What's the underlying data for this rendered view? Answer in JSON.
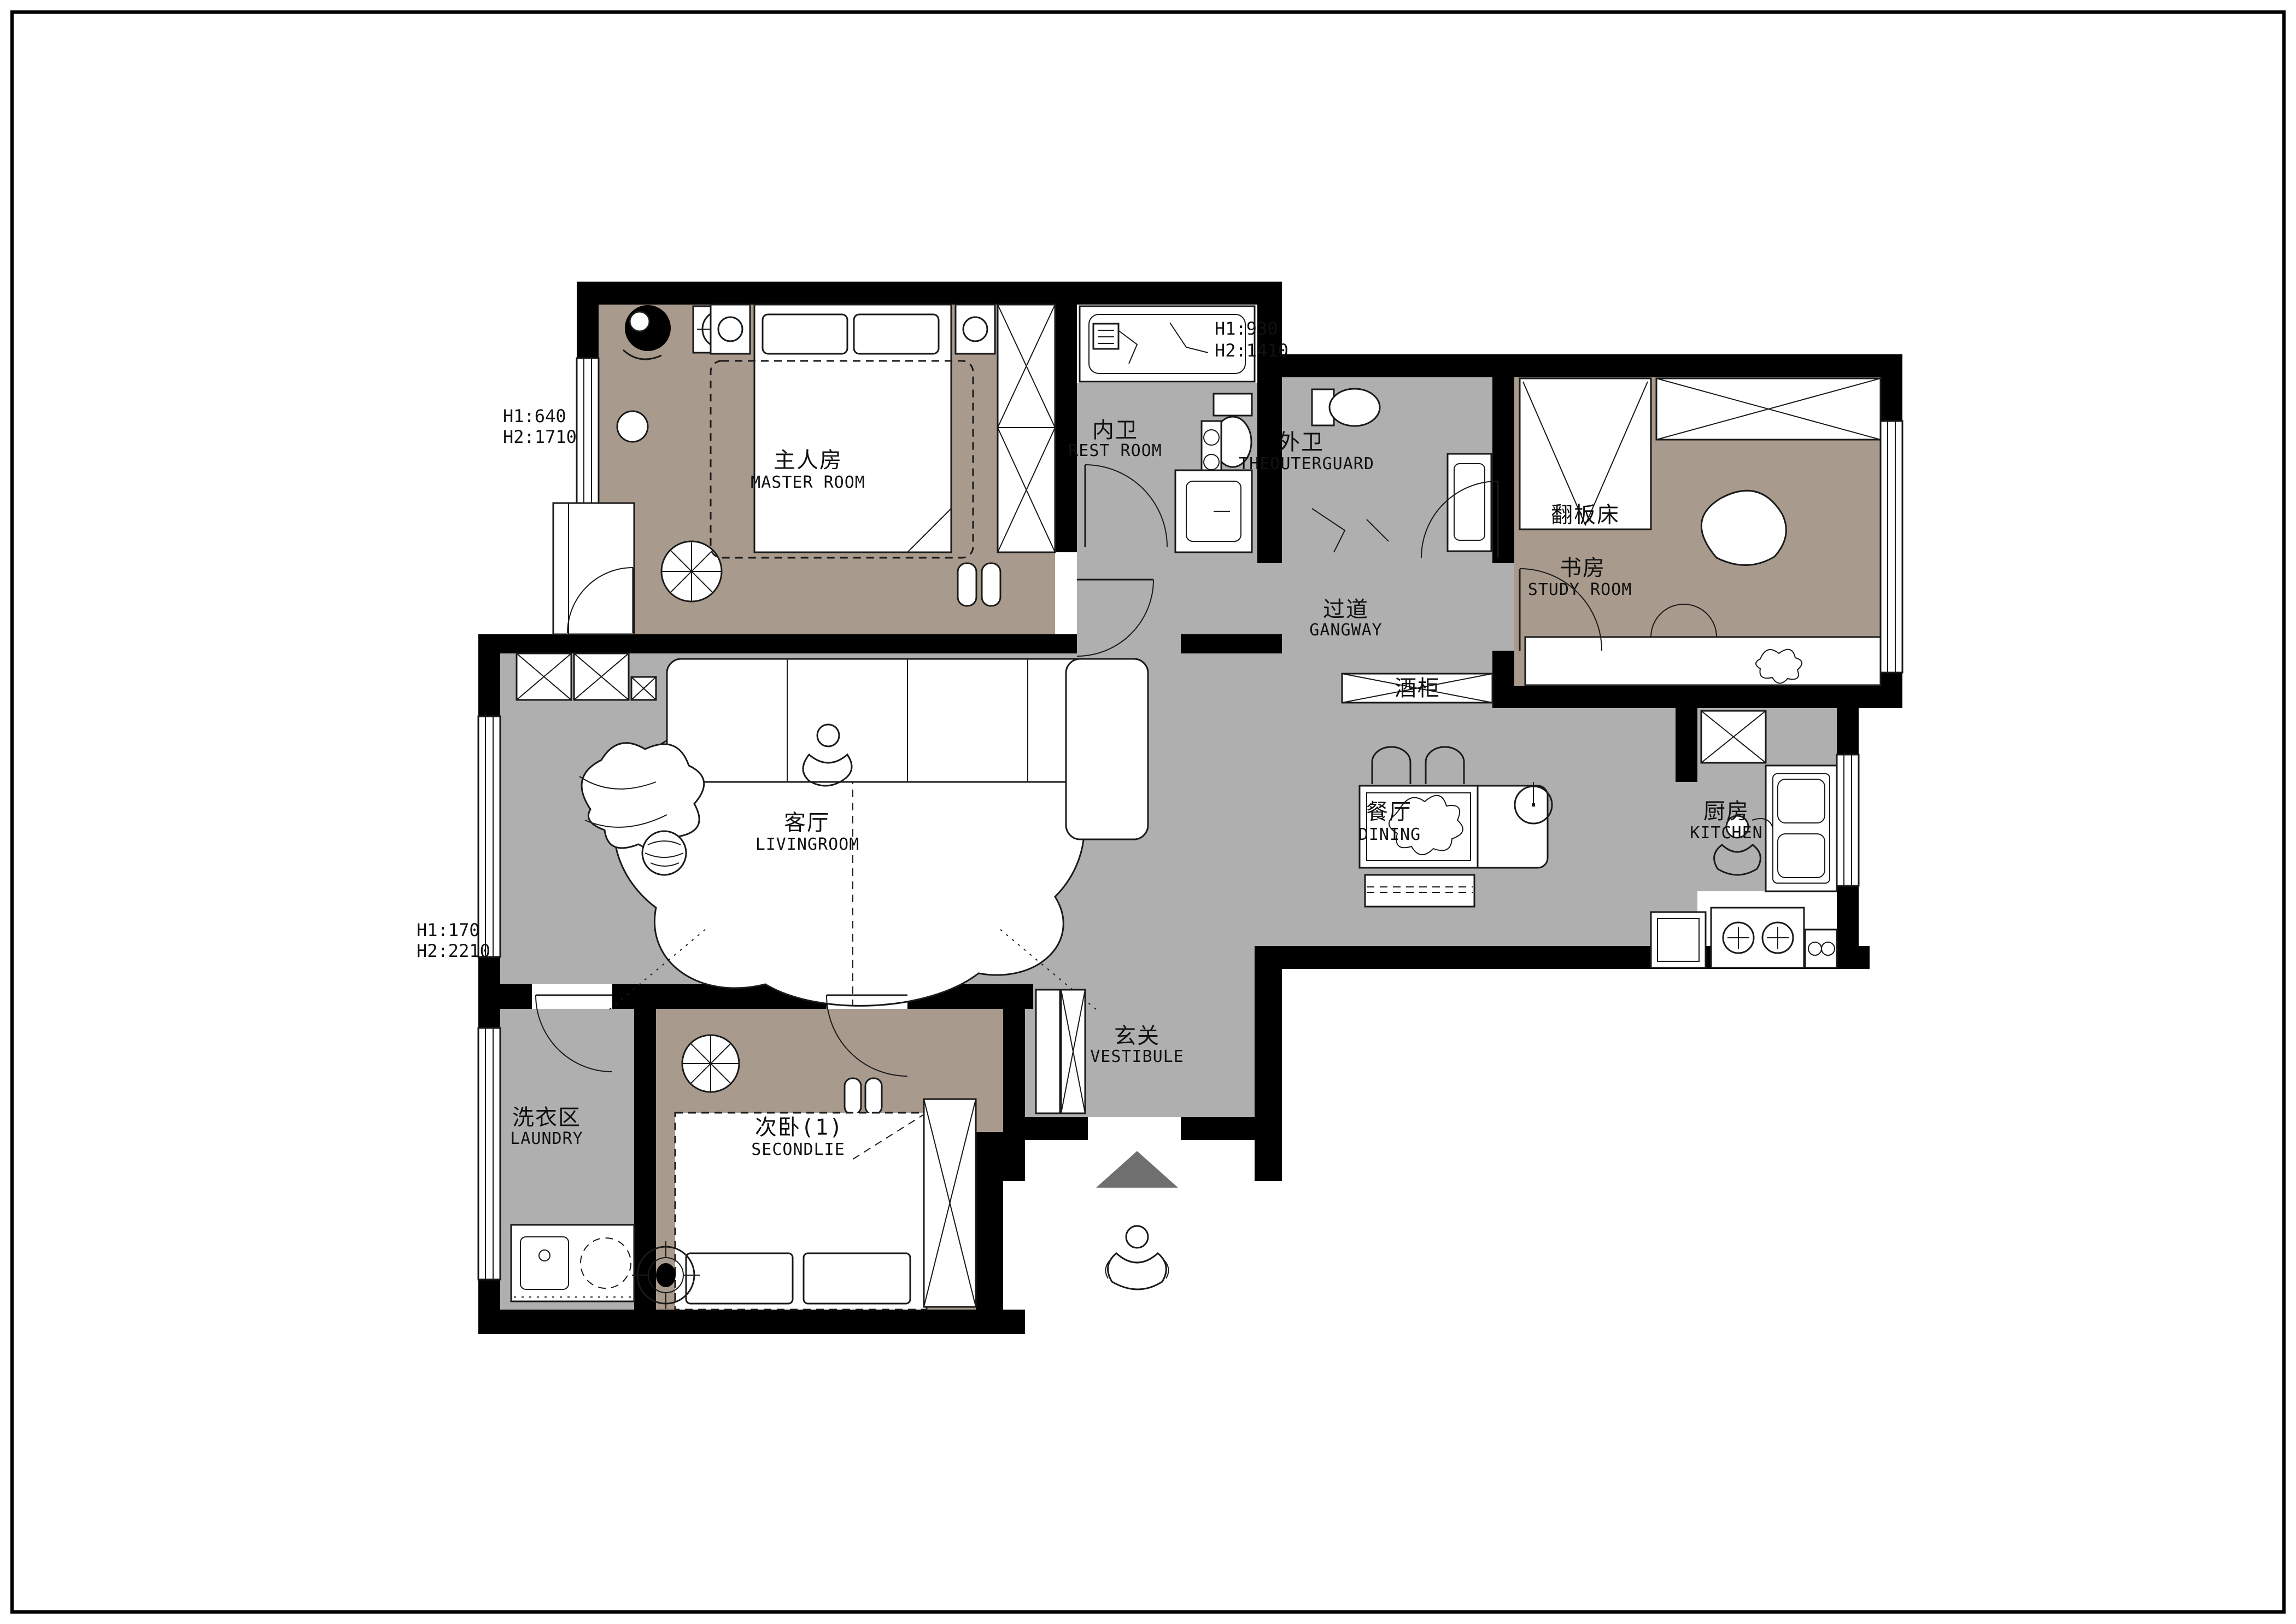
{
  "colors": {
    "paper": "#ffffff",
    "floor_brown": "#a89a8c",
    "floor_gray": "#afafaf",
    "wall": "#000000",
    "line": "#1a1a1a",
    "arrow_gray": "#6f6f6f"
  },
  "rooms": {
    "master": {
      "zh": "主人房",
      "en": "MASTER ROOM"
    },
    "restroom": {
      "zh": "内卫",
      "en": "REST ROOM"
    },
    "outerguard": {
      "zh": "外卫",
      "en": "THEOUTERGUARD"
    },
    "study": {
      "zh": "书房",
      "en": "STUDY ROOM"
    },
    "gangway": {
      "zh": "过道",
      "en": "GANGWAY"
    },
    "living": {
      "zh": "客厅",
      "en": "LIVINGROOM"
    },
    "dining": {
      "zh": "餐厅",
      "en": "DINING"
    },
    "kitchen": {
      "zh": "厨房",
      "en": "KITCHEN"
    },
    "vestibule": {
      "zh": "玄关",
      "en": "VESTIBULE"
    },
    "laundry": {
      "zh": "洗衣区",
      "en": "LAUNDRY"
    },
    "secondlie": {
      "zh": "次卧(1)",
      "en": "SECONDLIE"
    }
  },
  "fixtures": {
    "flip_bed": "翻板床",
    "wine_cabinet": "酒柜"
  },
  "annotations": {
    "master_window": {
      "l1": "H1:640",
      "l2": "H2:1710"
    },
    "shaft": {
      "l1": "H1:930",
      "l2": "H2:1410"
    },
    "living_window": {
      "l1": "H1:170",
      "l2": "H2:2210"
    }
  }
}
